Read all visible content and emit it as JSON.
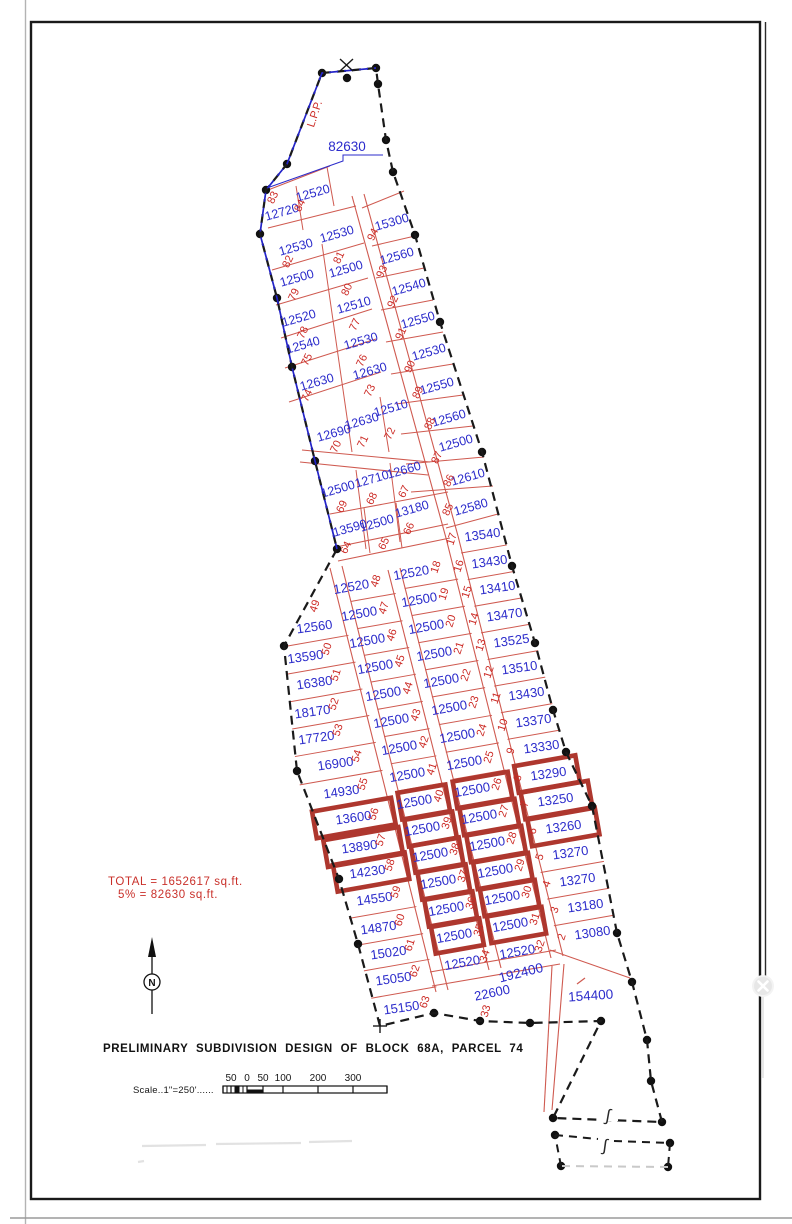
{
  "title": "PRELIMINARY SUBDIVISION DESIGN OF BLOCK 68A, PARCEL 74",
  "annotations": {
    "lpp": "L.P.P.",
    "boundary_area_label": "82630",
    "total_line1": "TOTAL = 1652617 sq.ft.",
    "total_line2": "5% = 82630 sq.ft.",
    "north_letter": "N",
    "break_symbol": "∫"
  },
  "scale": {
    "text": "Scale..1\"=250'......",
    "ticks": [
      "50",
      "0",
      "50",
      "100",
      "200",
      "300"
    ]
  },
  "colors": {
    "boundary_black": "#1a1a1a",
    "boundary_blue": "#2323c8",
    "lot_line_red": "#cf5a50",
    "lot_number_red": "#cc2b26",
    "area_blue": "#2b2bcb",
    "highlight_red": "#ae372e"
  },
  "close_button": {
    "icon": "x-close"
  },
  "big_lots": [
    {
      "area": "192400",
      "x": 522,
      "y": 973,
      "rot": -14
    },
    {
      "area": "154400",
      "x": 591,
      "y": 996,
      "rot": -4
    }
  ],
  "extra_lots": [
    {
      "n": "33",
      "a": "22600",
      "x": 493,
      "y": 993,
      "nx": 489,
      "ny": 1009,
      "rot": -12
    }
  ],
  "upper_lots": [
    {
      "n": "83",
      "a": "12720",
      "x": 283,
      "y": 212,
      "nx": 276,
      "ny": 196
    },
    {
      "n": "84",
      "a": "12520",
      "x": 314,
      "y": 193,
      "nx": 303,
      "ny": 204
    },
    {
      "n": "82",
      "a": "12530",
      "x": 297,
      "y": 247,
      "nx": 291,
      "ny": 260
    },
    {
      "n": "81",
      "a": "12530",
      "x": 338,
      "y": 234,
      "nx": 342,
      "ny": 256
    },
    {
      "n": "79",
      "a": "12500",
      "x": 298,
      "y": 278,
      "nx": 297,
      "ny": 293
    },
    {
      "n": "80",
      "a": "12500",
      "x": 347,
      "y": 269,
      "nx": 350,
      "ny": 288
    },
    {
      "n": "78",
      "a": "12520",
      "x": 300,
      "y": 318,
      "nx": 306,
      "ny": 331
    },
    {
      "n": "77",
      "a": "12510",
      "x": 355,
      "y": 305,
      "nx": 358,
      "ny": 323
    },
    {
      "n": "75",
      "a": "12540",
      "x": 304,
      "y": 345,
      "nx": 310,
      "ny": 358
    },
    {
      "n": "76",
      "a": "12530",
      "x": 362,
      "y": 341,
      "nx": 365,
      "ny": 359
    },
    {
      "n": "74",
      "a": "12630",
      "x": 318,
      "y": 382,
      "nx": 310,
      "ny": 394
    },
    {
      "n": "73",
      "a": "12630",
      "x": 371,
      "y": 371,
      "nx": 373,
      "ny": 389
    },
    {
      "n": "70",
      "a": "12690",
      "x": 335,
      "y": 433,
      "nx": 339,
      "ny": 445
    },
    {
      "n": "71",
      "a": "12630",
      "x": 363,
      "y": 421,
      "nx": 366,
      "ny": 440
    },
    {
      "n": "72",
      "a": "12510",
      "x": 392,
      "y": 408,
      "nx": 393,
      "ny": 432
    },
    {
      "n": "69",
      "a": "12500",
      "x": 339,
      "y": 489,
      "nx": 345,
      "ny": 505
    },
    {
      "n": "68",
      "a": "12710",
      "x": 373,
      "y": 479,
      "nx": 375,
      "ny": 497
    },
    {
      "n": "67",
      "a": "12660",
      "x": 405,
      "y": 470,
      "nx": 407,
      "ny": 490
    },
    {
      "n": "64",
      "a": "13590",
      "x": 351,
      "y": 528,
      "nx": 349,
      "ny": 546
    },
    {
      "n": "65",
      "a": "12500",
      "x": 378,
      "y": 523,
      "nx": 387,
      "ny": 542
    },
    {
      "n": "66",
      "a": "13180",
      "x": 413,
      "y": 509,
      "nx": 412,
      "ny": 527
    },
    {
      "n": "94",
      "a": "15300",
      "x": 393,
      "y": 222,
      "nx": 376,
      "ny": 233
    },
    {
      "n": "93",
      "a": "12560",
      "x": 398,
      "y": 256,
      "nx": 385,
      "ny": 270
    },
    {
      "n": "92",
      "a": "12540",
      "x": 410,
      "y": 287,
      "nx": 396,
      "ny": 300
    },
    {
      "n": "91",
      "a": "12550",
      "x": 419,
      "y": 320,
      "nx": 404,
      "ny": 332
    },
    {
      "n": "90",
      "a": "12530",
      "x": 430,
      "y": 352,
      "nx": 413,
      "ny": 365
    },
    {
      "n": "89",
      "a": "12550",
      "x": 438,
      "y": 386,
      "nx": 421,
      "ny": 391
    },
    {
      "n": "88",
      "a": "12560",
      "x": 450,
      "y": 418,
      "nx": 433,
      "ny": 422
    },
    {
      "n": "87",
      "a": "12500",
      "x": 457,
      "y": 443,
      "nx": 440,
      "ny": 456
    },
    {
      "n": "86",
      "a": "12610",
      "x": 469,
      "y": 477,
      "nx": 452,
      "ny": 479
    },
    {
      "n": "85",
      "a": "12580",
      "x": 472,
      "y": 507,
      "nx": 451,
      "ny": 508
    }
  ],
  "columns": [
    {
      "id": "A",
      "area_rot": -8,
      "lots": [
        {
          "n": "49",
          "a": "12560",
          "x": 315,
          "y": 627,
          "nx": 318,
          "ny": 604
        },
        {
          "n": "50",
          "a": "13590",
          "x": 306,
          "y": 657,
          "nx": 330,
          "ny": 647
        },
        {
          "n": "51",
          "a": "16380",
          "x": 315,
          "y": 683,
          "nx": 339,
          "ny": 673
        },
        {
          "n": "52",
          "a": "18170",
          "x": 313,
          "y": 712,
          "nx": 337,
          "ny": 702
        },
        {
          "n": "53",
          "a": "17720",
          "x": 317,
          "y": 738,
          "nx": 341,
          "ny": 728
        },
        {
          "n": "54",
          "a": "16900",
          "x": 336,
          "y": 764,
          "nx": 360,
          "ny": 754
        },
        {
          "n": "55",
          "a": "14930",
          "x": 342,
          "y": 792,
          "nx": 366,
          "ny": 782
        },
        {
          "n": "56",
          "a": "13600",
          "x": 354,
          "y": 818,
          "nx": 377,
          "ny": 812,
          "hl": true
        },
        {
          "n": "57",
          "a": "13890",
          "x": 360,
          "y": 847,
          "nx": 384,
          "ny": 838,
          "hl": true
        },
        {
          "n": "58",
          "a": "14230",
          "x": 368,
          "y": 872,
          "nx": 393,
          "ny": 863,
          "hl": true
        },
        {
          "n": "59",
          "a": "14550",
          "x": 375,
          "y": 899,
          "nx": 399,
          "ny": 890
        },
        {
          "n": "60",
          "a": "14870",
          "x": 379,
          "y": 928,
          "nx": 403,
          "ny": 918
        },
        {
          "n": "61",
          "a": "15020",
          "x": 389,
          "y": 953,
          "nx": 413,
          "ny": 943
        },
        {
          "n": "62",
          "a": "15050",
          "x": 394,
          "y": 979,
          "nx": 418,
          "ny": 969
        },
        {
          "n": "63",
          "a": "15150",
          "x": 402,
          "y": 1008,
          "nx": 428,
          "ny": 1000
        }
      ]
    },
    {
      "id": "B",
      "area_rot": -10,
      "lots": [
        {
          "n": "48",
          "a": "12520",
          "x": 352,
          "y": 587,
          "nx": 379,
          "ny": 579
        },
        {
          "n": "47",
          "a": "12500",
          "x": 360,
          "y": 614,
          "nx": 387,
          "ny": 606
        },
        {
          "n": "46",
          "a": "12500",
          "x": 368,
          "y": 641,
          "nx": 395,
          "ny": 633
        },
        {
          "n": "45",
          "a": "12500",
          "x": 376,
          "y": 667,
          "nx": 403,
          "ny": 659
        },
        {
          "n": "44",
          "a": "12500",
          "x": 384,
          "y": 694,
          "nx": 411,
          "ny": 686
        },
        {
          "n": "43",
          "a": "12500",
          "x": 392,
          "y": 721,
          "nx": 419,
          "ny": 713
        },
        {
          "n": "42",
          "a": "12500",
          "x": 400,
          "y": 748,
          "nx": 427,
          "ny": 740
        },
        {
          "n": "41",
          "a": "12500",
          "x": 408,
          "y": 775,
          "nx": 435,
          "ny": 767
        },
        {
          "n": "40",
          "a": "12500",
          "x": 415,
          "y": 802,
          "nx": 442,
          "ny": 794,
          "hl": true
        },
        {
          "n": "39",
          "a": "12500",
          "x": 423,
          "y": 829,
          "nx": 450,
          "ny": 821,
          "hl": true
        },
        {
          "n": "38",
          "a": "12500",
          "x": 431,
          "y": 855,
          "nx": 458,
          "ny": 847,
          "hl": true
        },
        {
          "n": "37",
          "a": "12500",
          "x": 439,
          "y": 882,
          "nx": 466,
          "ny": 874,
          "hl": true
        },
        {
          "n": "36",
          "a": "12500",
          "x": 447,
          "y": 909,
          "nx": 474,
          "ny": 901,
          "hl": true
        },
        {
          "n": "35",
          "a": "12500",
          "x": 455,
          "y": 936,
          "nx": 482,
          "ny": 928,
          "hl": true
        },
        {
          "n": "34",
          "a": "12520",
          "x": 463,
          "y": 963,
          "nx": 488,
          "ny": 954
        }
      ]
    },
    {
      "id": "C",
      "area_rot": -10,
      "lots": [
        {
          "n": "18",
          "a": "12520",
          "x": 412,
          "y": 573,
          "nx": 439,
          "ny": 565
        },
        {
          "n": "19",
          "a": "12500",
          "x": 420,
          "y": 600,
          "nx": 447,
          "ny": 592
        },
        {
          "n": "20",
          "a": "12500",
          "x": 427,
          "y": 627,
          "nx": 454,
          "ny": 619
        },
        {
          "n": "21",
          "a": "12500",
          "x": 435,
          "y": 654,
          "nx": 462,
          "ny": 646
        },
        {
          "n": "22",
          "a": "12500",
          "x": 442,
          "y": 681,
          "nx": 469,
          "ny": 673
        },
        {
          "n": "23",
          "a": "12500",
          "x": 450,
          "y": 708,
          "nx": 477,
          "ny": 700
        },
        {
          "n": "24",
          "a": "12500",
          "x": 458,
          "y": 736,
          "nx": 485,
          "ny": 728
        },
        {
          "n": "25",
          "a": "12500",
          "x": 465,
          "y": 763,
          "nx": 492,
          "ny": 755
        },
        {
          "n": "26",
          "a": "12500",
          "x": 473,
          "y": 790,
          "nx": 500,
          "ny": 782,
          "hl": true
        },
        {
          "n": "27",
          "a": "12500",
          "x": 480,
          "y": 817,
          "nx": 507,
          "ny": 809,
          "hl": true
        },
        {
          "n": "28",
          "a": "12500",
          "x": 488,
          "y": 844,
          "nx": 515,
          "ny": 836,
          "hl": true
        },
        {
          "n": "29",
          "a": "12500",
          "x": 496,
          "y": 871,
          "nx": 523,
          "ny": 863,
          "hl": true
        },
        {
          "n": "30",
          "a": "12500",
          "x": 503,
          "y": 898,
          "nx": 530,
          "ny": 890,
          "hl": true
        },
        {
          "n": "31",
          "a": "12500",
          "x": 511,
          "y": 925,
          "nx": 538,
          "ny": 917,
          "hl": true
        },
        {
          "n": "32",
          "a": "12520",
          "x": 518,
          "y": 952,
          "nx": 543,
          "ny": 944
        }
      ]
    },
    {
      "id": "D",
      "area_rot": -8,
      "lots": [
        {
          "n": "17",
          "a": "13540",
          "x": 483,
          "y": 535,
          "nx": 455,
          "ny": 537
        },
        {
          "n": "16",
          "a": "13430",
          "x": 490,
          "y": 562,
          "nx": 462,
          "ny": 564
        },
        {
          "n": "15",
          "a": "13410",
          "x": 498,
          "y": 588,
          "nx": 470,
          "ny": 590
        },
        {
          "n": "14",
          "a": "13470",
          "x": 505,
          "y": 615,
          "nx": 477,
          "ny": 617
        },
        {
          "n": "13",
          "a": "13525",
          "x": 512,
          "y": 641,
          "nx": 484,
          "ny": 643
        },
        {
          "n": "12",
          "a": "13510",
          "x": 520,
          "y": 668,
          "nx": 492,
          "ny": 670
        },
        {
          "n": "11",
          "a": "13430",
          "x": 527,
          "y": 694,
          "nx": 499,
          "ny": 696
        },
        {
          "n": "10",
          "a": "13370",
          "x": 534,
          "y": 721,
          "nx": 506,
          "ny": 723
        },
        {
          "n": "9",
          "a": "13330",
          "x": 542,
          "y": 747,
          "nx": 514,
          "ny": 749
        },
        {
          "n": "8",
          "a": "13290",
          "x": 549,
          "y": 774,
          "nx": 521,
          "ny": 776,
          "hl": true
        },
        {
          "n": "7",
          "a": "13250",
          "x": 556,
          "y": 800,
          "nx": 528,
          "ny": 802,
          "hl": true
        },
        {
          "n": "6",
          "a": "13260",
          "x": 564,
          "y": 827,
          "nx": 536,
          "ny": 829,
          "hl": true
        },
        {
          "n": "5",
          "a": "13270",
          "x": 571,
          "y": 853,
          "nx": 543,
          "ny": 855
        },
        {
          "n": "4",
          "a": "13270",
          "x": 578,
          "y": 880,
          "nx": 550,
          "ny": 882
        },
        {
          "n": "3",
          "a": "13180",
          "x": 586,
          "y": 906,
          "nx": 558,
          "ny": 908
        },
        {
          "n": "2",
          "a": "13080",
          "x": 593,
          "y": 933,
          "nx": 565,
          "ny": 935
        }
      ]
    }
  ]
}
